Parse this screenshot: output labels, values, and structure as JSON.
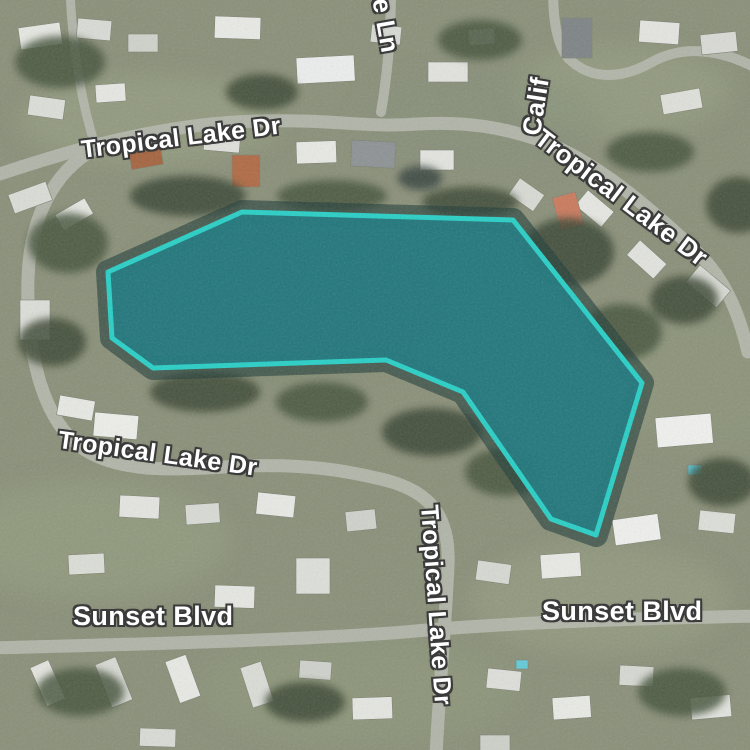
{
  "map": {
    "view": "satellite",
    "lake": {
      "name": "highlighted-lake-parcel",
      "polygon": [
        [
          242,
          212
        ],
        [
          513,
          220
        ],
        [
          642,
          383
        ],
        [
          596,
          535
        ],
        [
          551,
          519
        ],
        [
          463,
          392
        ],
        [
          386,
          360
        ],
        [
          153,
          368
        ],
        [
          112,
          338
        ],
        [
          108,
          272
        ]
      ],
      "fill": "#1F787E",
      "outline": "#28CFC6",
      "outline_width": 5
    },
    "street_labels": [
      {
        "key": "top-left",
        "text": "Tropical Lake Dr"
      },
      {
        "key": "top-right",
        "text": "Tropical Lake Dr"
      },
      {
        "key": "mid-left",
        "text": "Tropical Lake Dr"
      },
      {
        "key": "vertical",
        "text": "Tropical Lake Dr"
      },
      {
        "key": "sunset-left",
        "text": "Sunset Blvd"
      },
      {
        "key": "sunset-right",
        "text": "Sunset Blvd"
      },
      {
        "key": "lane-partial",
        "text": "e Ln"
      },
      {
        "key": "california-partial",
        "text": "Calif"
      }
    ]
  }
}
